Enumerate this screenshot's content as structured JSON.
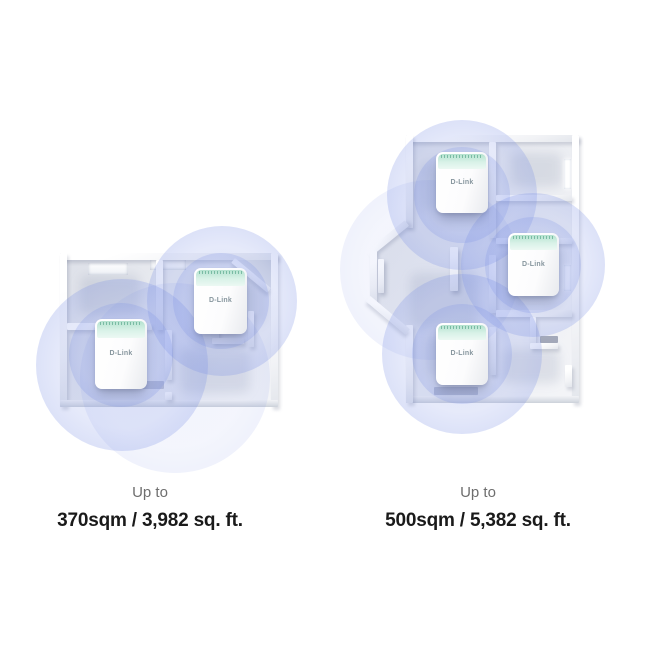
{
  "page": {
    "background_color": "#ffffff"
  },
  "brand": {
    "device_logo": "D-Link"
  },
  "colors": {
    "coverage_circle_blue": "#7e92e5",
    "device_top_mint": "#cdeede",
    "floor_gray": "#e9ebf0",
    "wall_white": "#fdfdfe",
    "caption_gray": "#6e6e6e",
    "coverage_text_black": "#1a1a1a"
  },
  "figures": [
    {
      "name": "two-node-floorplan",
      "caption": {
        "prefix": "Up to",
        "coverage": "370sqm / 3,982 sq. ft."
      },
      "devices": [
        {
          "label": "D-Link"
        },
        {
          "label": "D-Link"
        }
      ]
    },
    {
      "name": "three-node-floorplan",
      "caption": {
        "prefix": "Up to",
        "coverage": "500sqm / 5,382 sq. ft."
      },
      "devices": [
        {
          "label": "D-Link"
        },
        {
          "label": "D-Link"
        },
        {
          "label": "D-Link"
        }
      ]
    }
  ]
}
